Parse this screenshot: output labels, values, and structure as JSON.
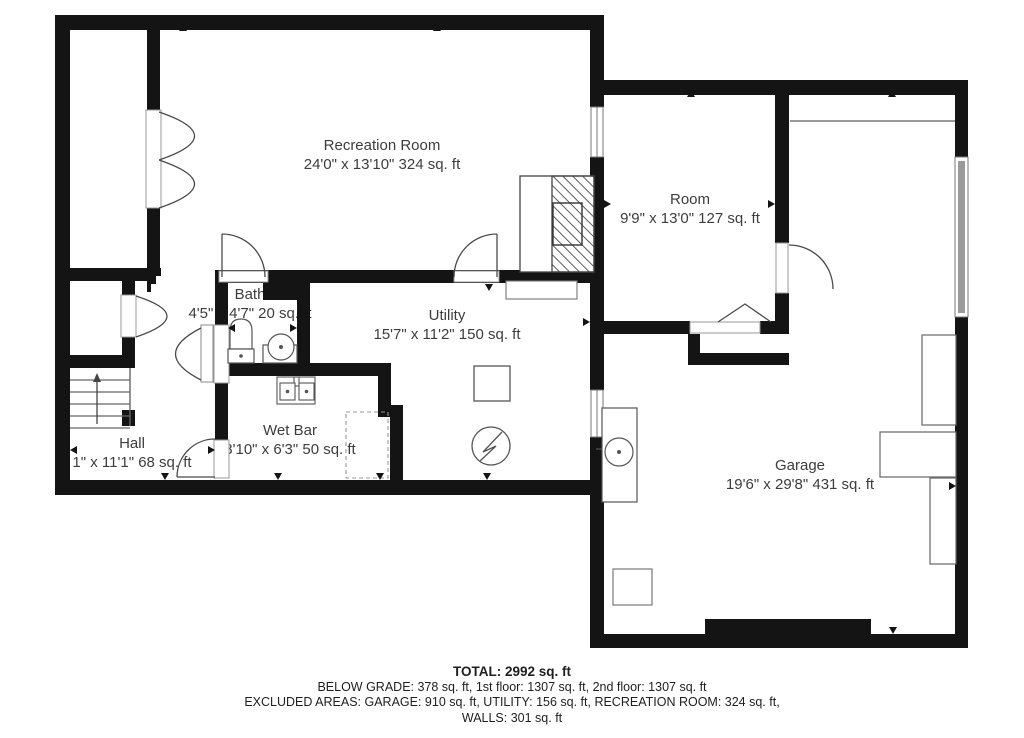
{
  "plan": {
    "title": "Basement floor plan",
    "rooms": [
      {
        "name": "Recreation Room",
        "dims": "24'0\" x 13'10\" 324 sq. ft"
      },
      {
        "name": "Room",
        "dims": "9'9\" x 13'0\" 127 sq. ft"
      },
      {
        "name": "Bath",
        "dims": "4'5\" x 4'7\" 20 sq. ft"
      },
      {
        "name": "Utility",
        "dims": "15'7\" x 11'2\" 150 sq. ft"
      },
      {
        "name": "Wet Bar",
        "dims": "8'10\" x 6'3\" 50 sq. ft"
      },
      {
        "name": "Hall",
        "dims": "1\" x 11'1\" 68 sq. ft"
      },
      {
        "name": "Garage",
        "dims": "19'6\" x 29'8\" 431 sq. ft"
      }
    ],
    "summary": {
      "total": "TOTAL: 2992 sq. ft",
      "line2": "BELOW GRADE: 378 sq. ft, 1st floor: 1307 sq. ft, 2nd floor: 1307 sq. ft",
      "line3": "EXCLUDED AREAS: GARAGE: 910 sq. ft, UTILITY: 156 sq. ft, RECREATION ROOM: 324 sq. ft,",
      "line4": "WALLS: 301 sq. ft"
    },
    "colors": {
      "wall": "#141414",
      "text": "#3d3d3d"
    }
  }
}
